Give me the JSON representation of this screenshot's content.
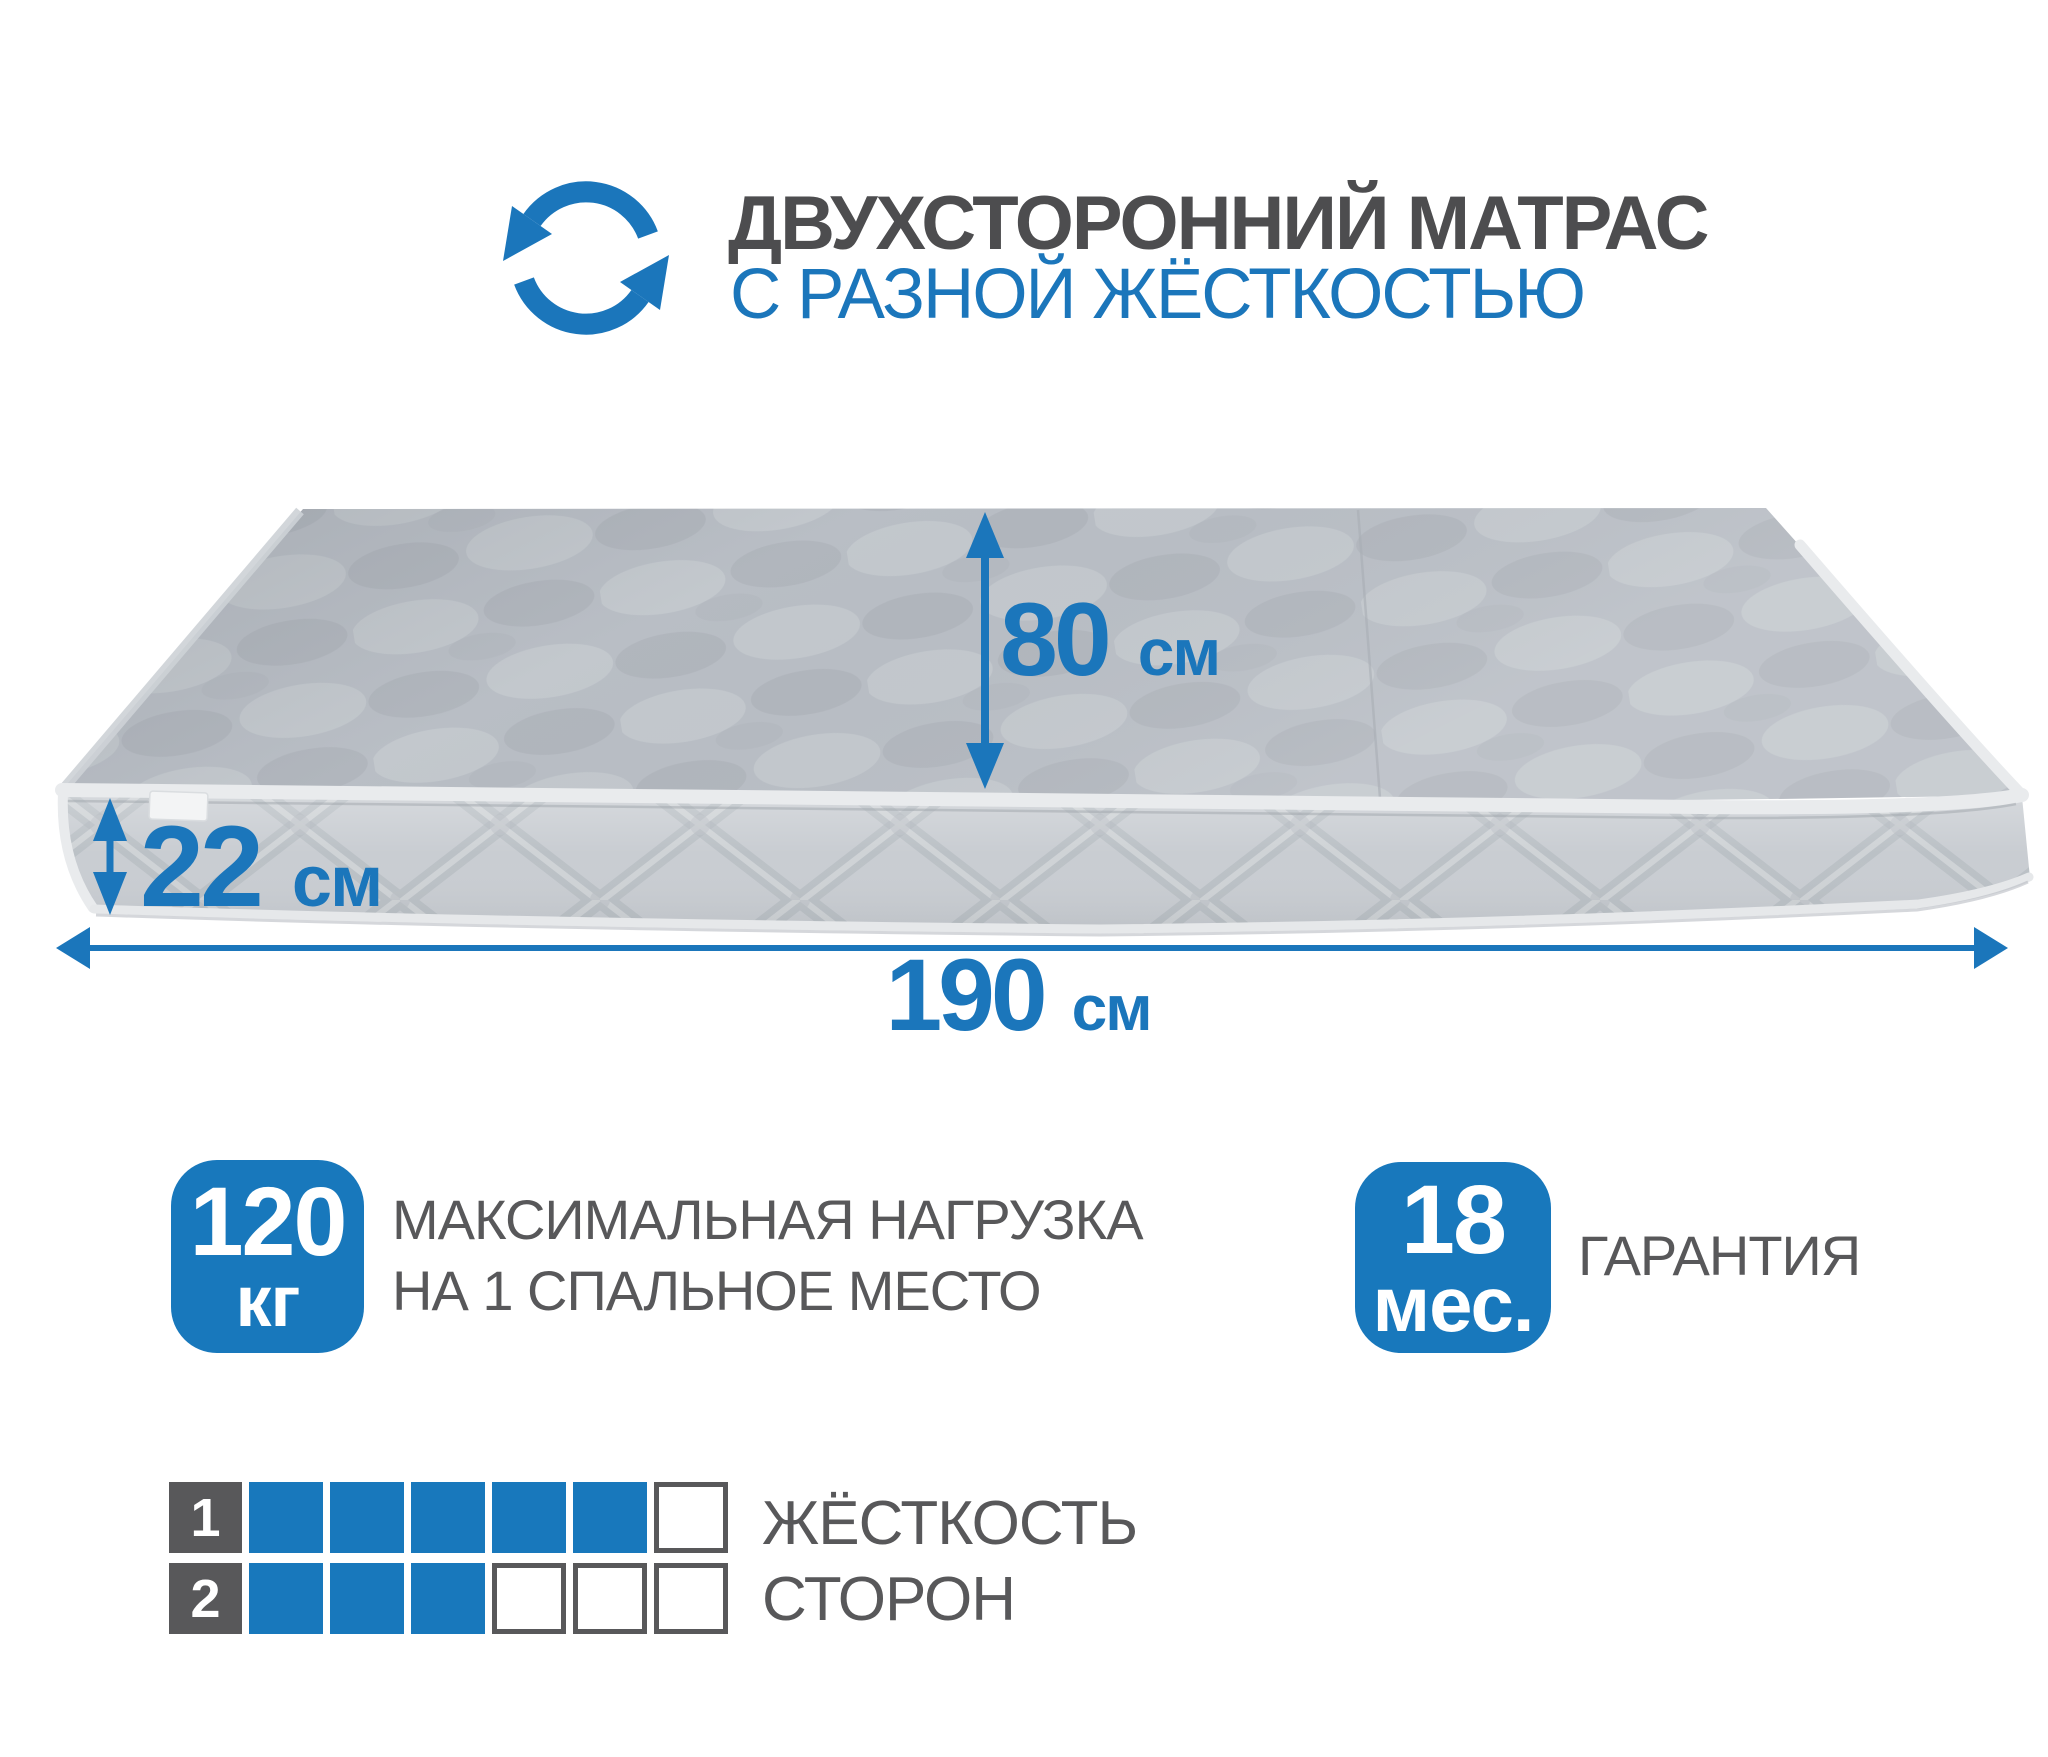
{
  "header": {
    "rotate_icon": "double-rotation-arrows",
    "title_line1": "ДВУХСТОРОННИЙ МАТРАС",
    "title_line2": "С РАЗНОЙ ЖЁСТКОСТЬЮ"
  },
  "mattress": {
    "dimensions": {
      "width": {
        "value": "80",
        "unit": "см"
      },
      "height": {
        "value": "22",
        "unit": "см"
      },
      "length": {
        "value": "190",
        "unit": "см"
      }
    }
  },
  "features": {
    "max_load": {
      "value": "120",
      "unit": "кг",
      "label_line1": "МАКСИМАЛЬНАЯ НАГРУЗКА",
      "label_line2": "НА 1 СПАЛЬНОЕ МЕСТО"
    },
    "warranty": {
      "value": "18",
      "unit": "мес.",
      "label": "ГАРАНТИЯ"
    }
  },
  "firmness": {
    "caption_line1": "ЖЁСТКОСТЬ",
    "caption_line2": "СТОРОН",
    "scale_max": 6,
    "sides": [
      {
        "label": "1",
        "filled": 5
      },
      {
        "label": "2",
        "filled": 3
      }
    ]
  },
  "colors": {
    "accent_blue": "#1b76bb",
    "badge_blue": "#1878bc",
    "title_gray": "#4d4d4f",
    "label_gray": "#58585a",
    "mattress_top": "#b9bec5",
    "mattress_side": "#c9cdd2",
    "piping": "#e9ebed"
  }
}
